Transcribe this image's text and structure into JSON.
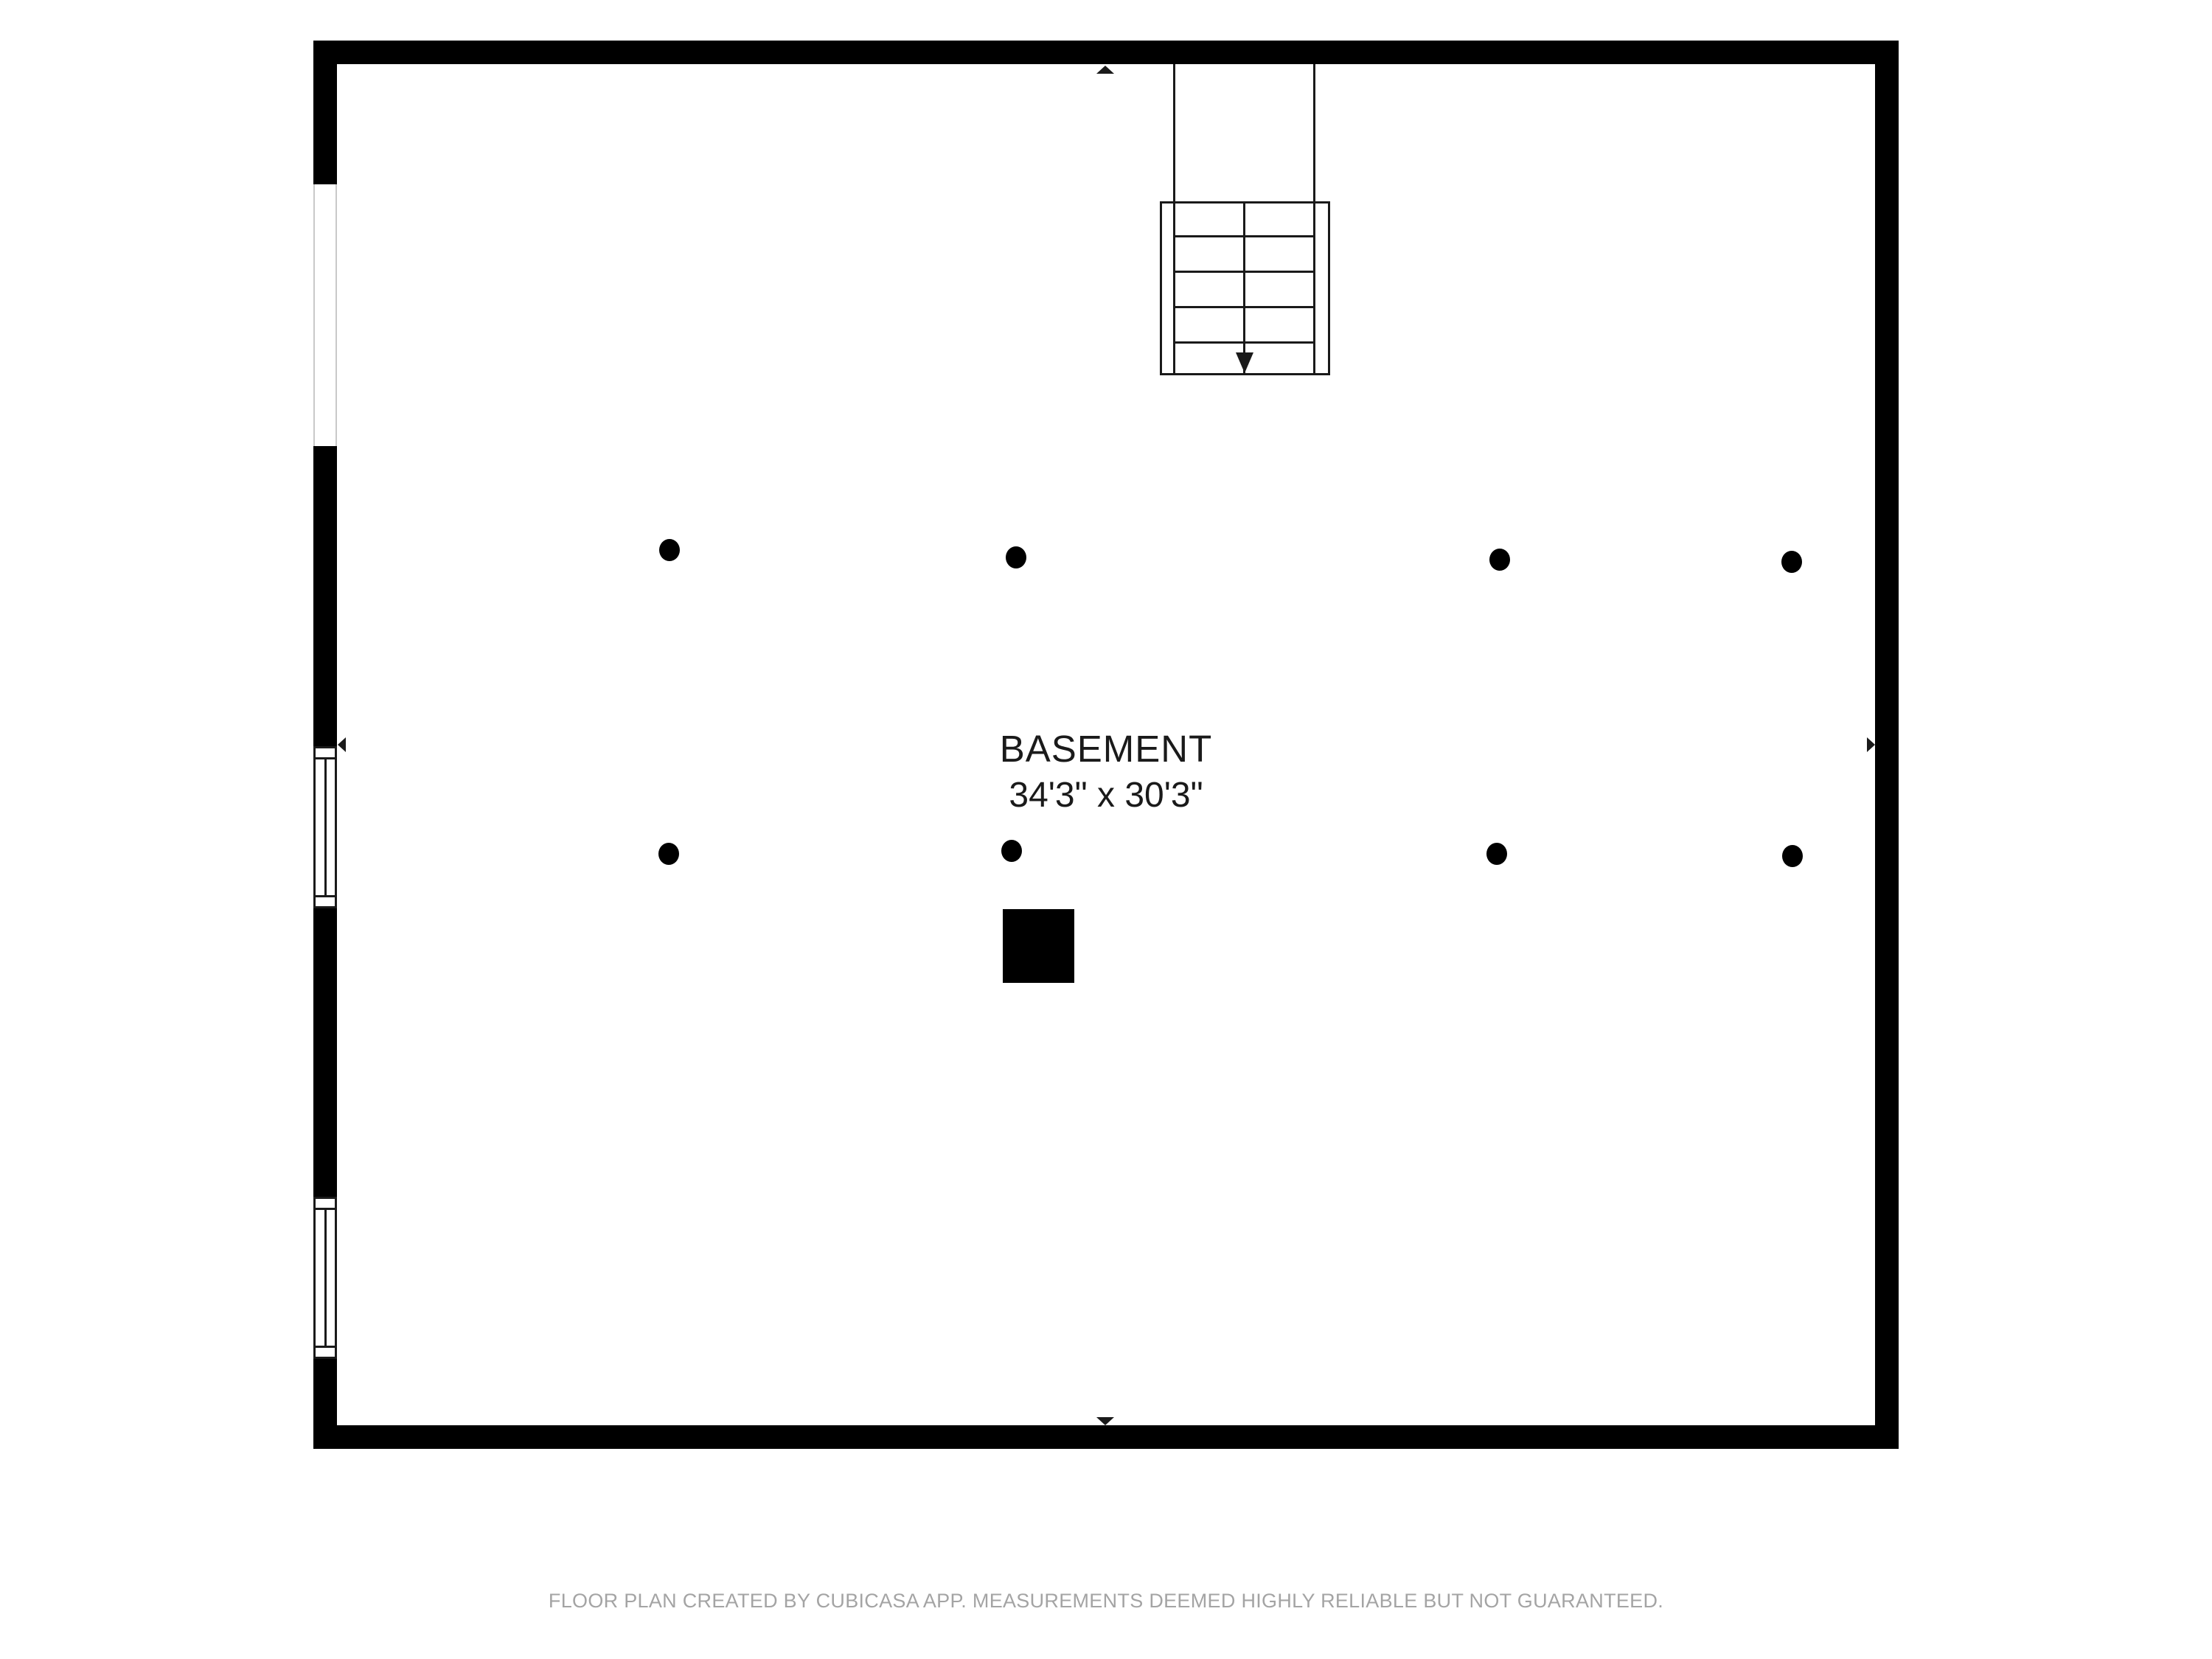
{
  "floorplan": {
    "room_label": "BASEMENT",
    "room_dimensions": "34'3\" x 30'3\"",
    "stairs": {
      "visible_treads": 5,
      "arrow_direction": "down"
    },
    "support_columns": {
      "count": 8,
      "rows": 2,
      "positions": [
        [
          908,
          746
        ],
        [
          1378,
          756
        ],
        [
          2034,
          759
        ],
        [
          2430,
          762
        ],
        [
          907,
          1158
        ],
        [
          1372,
          1154
        ],
        [
          2030,
          1158
        ],
        [
          2431,
          1161
        ]
      ]
    },
    "left_wall": {
      "plain_openings": 1,
      "windows": 2
    },
    "wall_midpoint_markers": [
      "up",
      "down",
      "left",
      "right"
    ],
    "colors": {
      "wall": "#000000",
      "line": "#1a1a1a",
      "text": "#1a1a1a",
      "footer_text": "#a4a4a4",
      "opening_edge": "#c9c9c9",
      "background": "#ffffff"
    }
  },
  "footer": {
    "disclaimer": "FLOOR PLAN CREATED BY CUBICASA APP. MEASUREMENTS DEEMED HIGHLY RELIABLE BUT NOT GUARANTEED."
  }
}
